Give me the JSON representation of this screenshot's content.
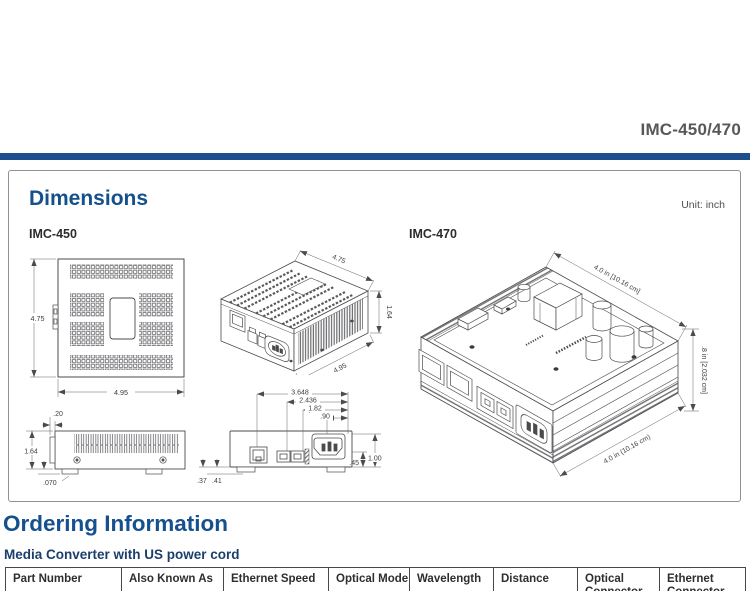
{
  "page": {
    "product_code": "IMC-450/470"
  },
  "dimensions": {
    "title": "Dimensions",
    "unit_label": "Unit: inch",
    "imc450": {
      "label": "IMC-450",
      "top_view": {
        "width": "4.95",
        "depth": "4.75"
      },
      "iso_view": {
        "depth": "4.75",
        "height": "1.64",
        "width": "4.95"
      },
      "side_view": {
        "lip": ".20",
        "height": "1.64",
        "foot": ".070"
      },
      "rear_view": {
        "rj45_offset": "3.648",
        "fiber_offset": "2.436",
        "fiber2_offset": "1.82",
        "power_offset": ".90",
        "left_a": ".37",
        "left_b": ".41",
        "right_a": ".45",
        "right_b": "1.00"
      }
    },
    "imc470": {
      "label": "IMC-470",
      "top_dim": "4.0 in [10.16 cm]",
      "height_dim": ".8 in [2.032 cm]",
      "bottom_dim": "4.0 in (10.16 cm)"
    }
  },
  "ordering": {
    "title": "Ordering Information",
    "subtitle": "Media Converter with US power cord",
    "table": {
      "headers": [
        "Part Number",
        "Also Known As",
        "Ethernet Speed",
        "Optical Mode",
        "Wavelength",
        "Distance",
        "Optical\nConnector",
        "Ethernet\nConnector"
      ]
    }
  }
}
